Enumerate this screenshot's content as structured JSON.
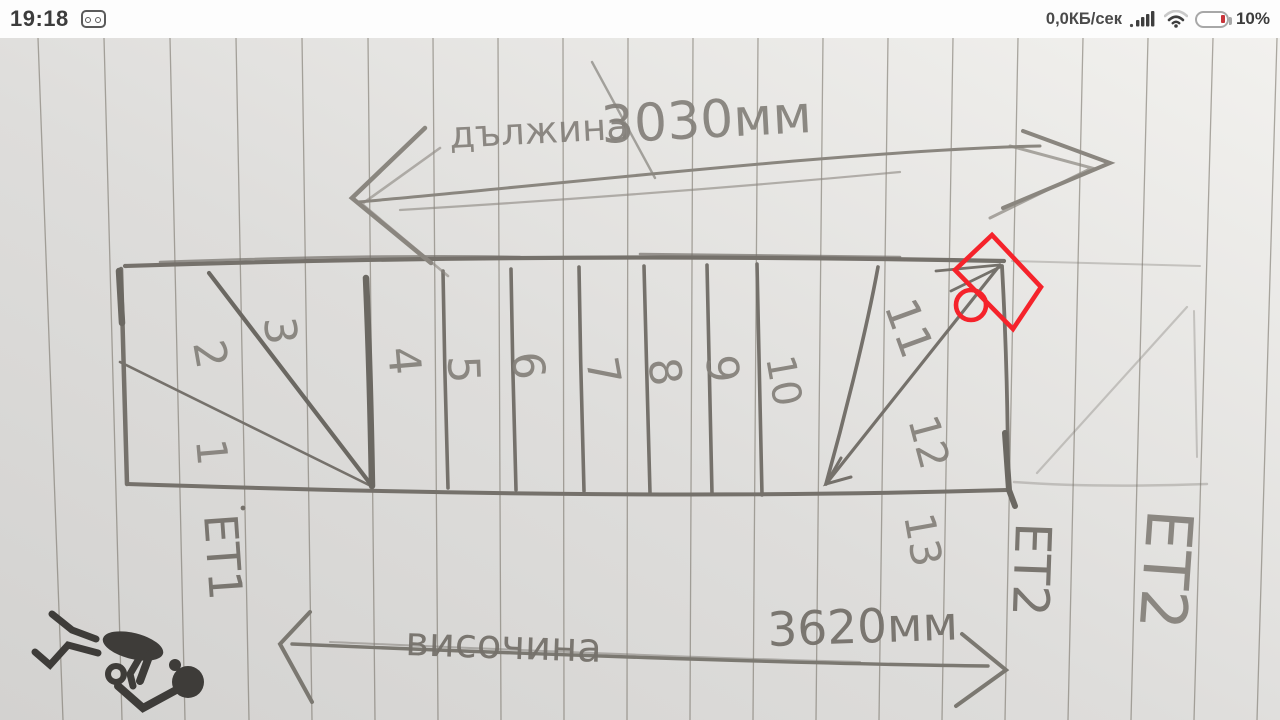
{
  "status_bar": {
    "time": "19:18",
    "net_speed": "0,0КБ/сек",
    "battery_percent": "10%"
  },
  "diagram": {
    "length_label": "дължина",
    "length_value": "3030мм",
    "height_label": "височина",
    "height_value": "3620мм",
    "floor_start": "ЕТ1",
    "floor_end": "ЕТ2",
    "floor_end_faint": "ЕТ2",
    "step_numbers": [
      "1",
      "2",
      "3",
      "4",
      "5",
      "6",
      "7",
      "8",
      "9",
      "10",
      "11",
      "12",
      "13"
    ]
  },
  "colors": {
    "pencil": "#7b7871",
    "pencil_dark": "#6b6862",
    "pencil_light": "#a09c94",
    "ruled_line": "#6f6a5e",
    "red_marker": "#f5232b",
    "ink_black": "#3e3c39",
    "paper_light": "#f2f1ee",
    "paper_dark": "#d3d2d0"
  }
}
